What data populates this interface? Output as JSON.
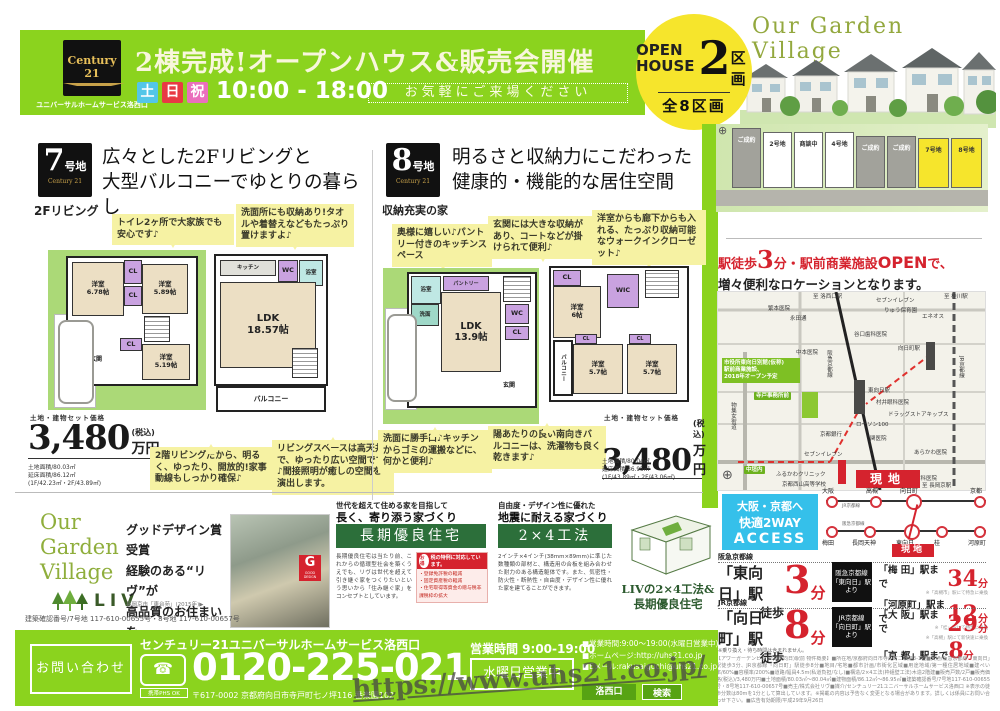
{
  "colors": {
    "green": "#8bd31e",
    "red": "#d5232e",
    "yellow": "#f6e52c",
    "cyan": "#3cc3ea",
    "dark_green": "#2c6f3a"
  },
  "watermark": "https://www.uhs21.co.jp/",
  "header": {
    "logo_brand": "Century 21",
    "logo_sub": "ユニバーサルホームサービス洛西口",
    "title": "2棟完成!オープンハウス&販売会開催",
    "day1": "土",
    "day2": "日",
    "day3": "祝",
    "time": "10:00 - 18:00",
    "note": "お気軽にご来場ください"
  },
  "village": {
    "name": "Our Garden Village",
    "open1": "OPEN",
    "open2": "HOUSE",
    "open_num": "2",
    "open_unit": "区画",
    "open_total": "全8区画",
    "lots": [
      {
        "label": "ご成約"
      },
      {
        "label": "2号地"
      },
      {
        "label": "商談中"
      },
      {
        "label": "4号地"
      },
      {
        "label": "ご成約"
      },
      {
        "label": "ご成約"
      },
      {
        "label": "7号地"
      },
      {
        "label": "8号地"
      }
    ]
  },
  "lot7": {
    "num": "7",
    "suffix": "号地",
    "brand": "Century 21",
    "tag": "2Fリビング",
    "headline": "広々とした2Fリビングと\n大型バルコニーでゆとりの暮らし",
    "callout1": "トイレ2ヶ所で大家族でも安心です♪",
    "callout2": "洗面所にも収納あり!タオルや着替えなどもたっぷり置けますよ♪",
    "callout3": "2階リビングだから、明るく、ゆったり、開放的!家事動線もしっかり確保♪",
    "callout4": "リビングスペースは高天井で、ゆったり広い空間です♪間接照明が癒しの空間を演出します。",
    "price_label": "土地・建物セット価格",
    "price": "3,480",
    "price_unit": "万円",
    "price_tax": "(税込)",
    "area1": "土地面積/80.03㎡",
    "area2": "延床面積/86.12㎡",
    "area3": "(1F/42.23㎡・2F/43.89㎡)",
    "rooms": {
      "r1": "洋室\n6.78帖",
      "r2": "洋室\n5.89帖",
      "r3": "洋室\n5.19帖",
      "ldk": "LDK\n18.57帖",
      "balcony": "バルコニー",
      "cl": "CL",
      "wc": "WC",
      "genkan": "玄関",
      "bath": "浴室",
      "kitchen": "キッチン"
    }
  },
  "lot8": {
    "num": "8",
    "suffix": "号地",
    "brand": "Century 21",
    "tag": "収納充実の家",
    "headline": "明るさと収納力にこだわった\n健康的・機能的な居住空間",
    "callout1": "奥様に嬉しい♪パントリー付きのキッチンスペース",
    "callout2": "玄関には大きな収納があり、コートなどが掛けられて便利♪",
    "callout3": "洋室からも廊下からも入れる、たっぷり収納可能なウォークインクローゼット♪",
    "callout4": "洗面に勝手口♪キッチンからゴミの運搬などに、何かと便利♪",
    "callout5": "陽あたりの良い南向きバルコニーは、洗濯物も良く乾きます♪",
    "price_label": "土地・建物セット価格",
    "price": "3,480",
    "price_unit": "万円",
    "price_tax": "(税込)",
    "area1": "土地面積/80.04㎡",
    "area2": "延床面積/86.95㎡",
    "area3": "(1F/43.89㎡・2F/43.06㎡)",
    "rooms": {
      "ldk": "LDK\n13.9帖",
      "pantry": "パントリー",
      "r1": "洋室\n6帖",
      "r2": "洋室\n5.7帖",
      "r3": "洋室\n5.7帖",
      "wic": "WIC",
      "balcony": "バルコニー",
      "cl": "CL",
      "wc": "WC",
      "genkan": "玄関",
      "senmen": "洗面",
      "bath": "浴室"
    }
  },
  "location": {
    "head1a": "駅徒歩",
    "head1b": "3",
    "head1c": "分・駅前商業施設",
    "head1d": "OPEN",
    "head1e": "で、",
    "head2": "増々便利なロケーションとなります。",
    "genchi": "現地",
    "shisetsu": "市役所東向日別館(仮称)\n駅前商業施設、\n2018年オープン予定",
    "labels": [
      "至 洛西口駅",
      "セブンイレブン",
      "りゅう保育園",
      "エネオス",
      "至 桂川駅",
      "繁本医院",
      "永田通",
      "谷口歯科医院",
      "中本医院",
      "阪急京都線",
      "向日町駅",
      "JR京都線",
      "寺戸事務所前",
      "東向日駅",
      "村井眼科医院",
      "ドラッグストアキップス",
      "ローソン100",
      "京都銀行",
      "関医院",
      "中垣内",
      "セブンイレブン",
      "あらかわ医院",
      "ふるかわクリニック",
      "宮本歯科医院",
      "至 西向日駅",
      "至 長岡京駅",
      "京都西山高等学校",
      "物集女街道"
    ]
  },
  "access": {
    "box1": "大阪・京都へ",
    "box2": "快適2WAY",
    "box3": "ACCESS",
    "jr_line": "JR京都線",
    "hk_line": "阪急京都線",
    "jr_stations": [
      "大阪",
      "高槻",
      "向日町",
      "京都"
    ],
    "hk_stations": [
      "梅田",
      "長岡天神",
      "東向日",
      "桂",
      "河原町"
    ],
    "genchi": "現地",
    "hk_label": "阪急京都線",
    "hk_station": "「東向日」駅",
    "hk_walk": "徒歩",
    "hk_min": "3",
    "hk_unit": "分",
    "hk_from": "阪急京都線\n「東向日」駅\nより",
    "hk_d1": "「梅 田」駅まで",
    "hk_d1min": "34",
    "hk_d1u": "分",
    "hk_d1note": "※「高槻市」駅にて特急に乗換",
    "hk_d2": "「河原町」駅まで",
    "hk_d2min": "12",
    "hk_d2u": "分",
    "hk_d2note": "※「桂」駅にて特急に乗換",
    "jr_label": "JR京都線",
    "jr_station": "「向日町」駅",
    "jr_walk": "徒歩",
    "jr_min": "8",
    "jr_unit": "分",
    "jr_from": "JR京都線\n「向日町」駅\nより",
    "jr_d1": "「大 阪」駅まで",
    "jr_d1min": "29",
    "jr_d1u": "分",
    "jr_d1note": "※「高槻」駅にて新快速に乗換",
    "jr_d2": "「京 都」駅まで",
    "jr_d2min": "8",
    "jr_d2u": "分",
    "note": "※乗り換え・待ち時間は含まれません。"
  },
  "promo": {
    "ogv1": "Our",
    "ogv2": "Garden",
    "ogv3": "Village",
    "liv": "LIV",
    "lead": "グッドデザイン賞受賞\n経験のある“リヴ”が\n高品質のお住まいを\nお届けします。",
    "caption": "長岡京市「東台苑」(2015年)▶",
    "gd": "GOOD DESIGN",
    "c1_head1": "世代を超えて住める家を目指して",
    "c1_head2": "長く、寄り添う家づくり",
    "c1_banner": "長期優良住宅",
    "c1_body": "長期優良住宅は当たり前、これからの循環型社会を築くうえでも、リヴは世代を超えて引き継ぐ家をつくりたいという思いから「住み継ぐ家」をコンセプトとしています。",
    "tax_badge": "お得",
    "tax_head": "税の特例に対応しています。",
    "tax_item1": "・登録免許税の軽減",
    "tax_item2": "・固定資産税の軽減",
    "tax_item3": "・住宅取得等資金の贈与税非課税枠の拡大",
    "c2_head1": "自由度・デザイン性に優れた",
    "c2_head2": "地震に耐える家づくり",
    "c2_banner": "2×4工法",
    "c2_body": "2インチ×4インチ(38mm×89mm)に準じた数種類の部材と、構造用の合板を組み合わせた耐力のある構造躯体です。また、気密性・防火性・断熱性・自由度・デザイン性に優れた家を建てることができます。",
    "diagram_caption": "LIVの2×4工法&\n長期優良住宅",
    "confirm": "建築確認番号/7号地 117-610-00655号・8号地 117-610-00657号"
  },
  "contact": {
    "inquiry": "お問い合わせ",
    "company": "センチュリー21ユニバーサルホームサービス洛西口",
    "phone": "0120-225-021",
    "freedial_note": "携帯PHS OK",
    "address": "〒617-0002 京都府向日市寺戸町七ノ坪116 番楽園102",
    "hours": "営業時間 9:00-19:00",
    "wed": "水曜日営業中",
    "b1": "■営業時間:9:00〜19:00(水曜日営業中)",
    "b2": "■ホームページ:http://uhs21.co.jp",
    "b3": "■Eメール:rakusaiguchi@uhs21.co.jp",
    "search_kw": "洛西口",
    "search_btn": "検索"
  },
  "fineprint": "【アワーガーデンビレッジ(東向日)駅前 物件概要】■所在地/京都府向日市寺戸町二枚溝3-1他■交通/阪急京都線「東向日」駅徒歩3分、JR京都線「向日町」駅徒歩8分■地目/宅地■都市計画/市街化区域■用途地域/第一種住居地域■建ぺい率/60%■容積率/200%■道路/幅員4.5m(私道負担/なし)■構造/2×4工法(枠組壁工法)木造2階建■販売戸数/2戸■販売価格(税込)/3,480万円■土地面積/80.03㎡〜80.04㎡■建物面積/86.12㎡〜86.95㎡■建築確認番号/7号地117-610-00655号・8号地117-610-00657号■売主/株式会社リヴ■媒介/センチュリー21ユニバーサルホームサービス洛西口 ※表示の徒歩分数は80mを1分として算出しています。※掲載の内容は予告なく変更となる場合があります。詳しくは係員にお問い合わせ下さい。■広告有効期限/平成29年9月26日"
}
